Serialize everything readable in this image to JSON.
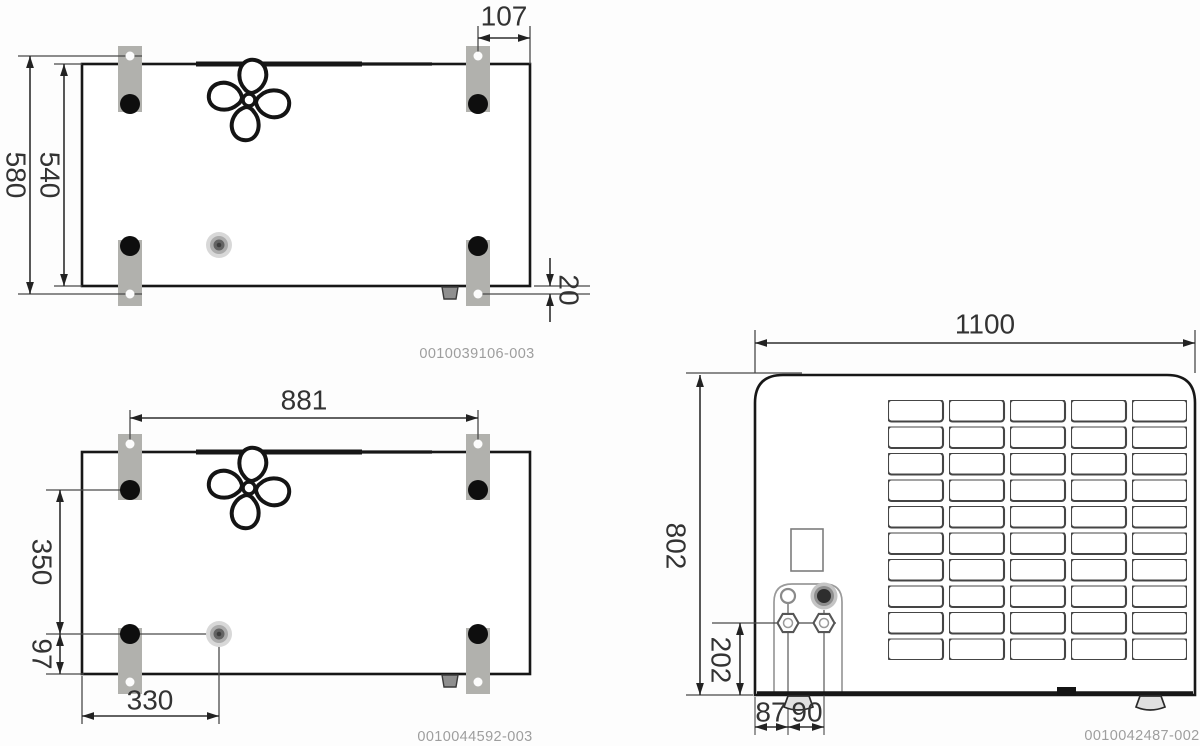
{
  "drawing": {
    "top_view_mounting": {
      "drawing_number": "0010039106-003",
      "dims": {
        "overall_depth": "580",
        "inner_depth": "540",
        "bracket_hole_offset": "107",
        "hole_overhang": "20"
      }
    },
    "top_view_spacing": {
      "drawing_number": "0010044592-003",
      "dims": {
        "hole_spacing_width": "881",
        "front_hole_to_drain": "350",
        "drain_to_edge": "97",
        "drain_offset_x": "330"
      }
    },
    "rear_view": {
      "drawing_number": "0010042487-002",
      "dims": {
        "unit_width": "1100",
        "unit_height": "802",
        "connection_height": "202",
        "connection_offset_1": "87",
        "connection_offset_2": "90"
      }
    },
    "colors": {
      "line": "#171717",
      "bracket_gray": "#b1b1ad",
      "dimension_text": "#333333",
      "drawing_number_gray": "#9e9e9e"
    }
  }
}
